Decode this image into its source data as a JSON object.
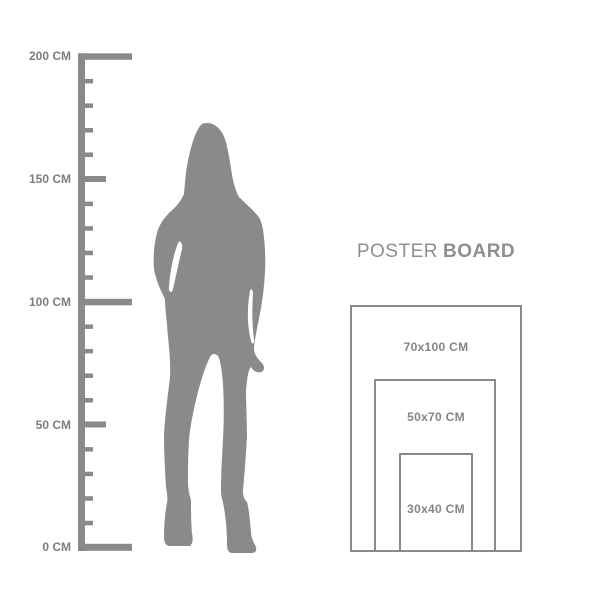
{
  "ruler": {
    "unit": "CM",
    "min_value_cm": 0,
    "max_value_cm": 200,
    "tick_interval_cm": 10,
    "labels": [
      {
        "value_cm": 200,
        "text": "200 CM"
      },
      {
        "value_cm": 150,
        "text": "150 CM"
      },
      {
        "value_cm": 100,
        "text": "100 CM"
      },
      {
        "value_cm": 50,
        "text": "50 CM"
      },
      {
        "value_cm": 0,
        "text": "0 CM"
      }
    ]
  },
  "figure": {
    "icon": "standing-woman-silhouette"
  },
  "poster_board": {
    "title": {
      "regular": "POSTER",
      "bold": "BOARD"
    },
    "sizes": [
      {
        "label": "70x100 CM",
        "width_cm": 70,
        "height_cm": 100
      },
      {
        "label": "50x70 CM",
        "width_cm": 50,
        "height_cm": 70
      },
      {
        "label": "30x40 CM",
        "width_cm": 30,
        "height_cm": 40
      }
    ]
  },
  "colors": {
    "artwork_gray": "#8a8a8a",
    "ruler_label_gray": "#7e7e7e",
    "title_gray": "#8f8f8f",
    "background": "#ffffff"
  }
}
